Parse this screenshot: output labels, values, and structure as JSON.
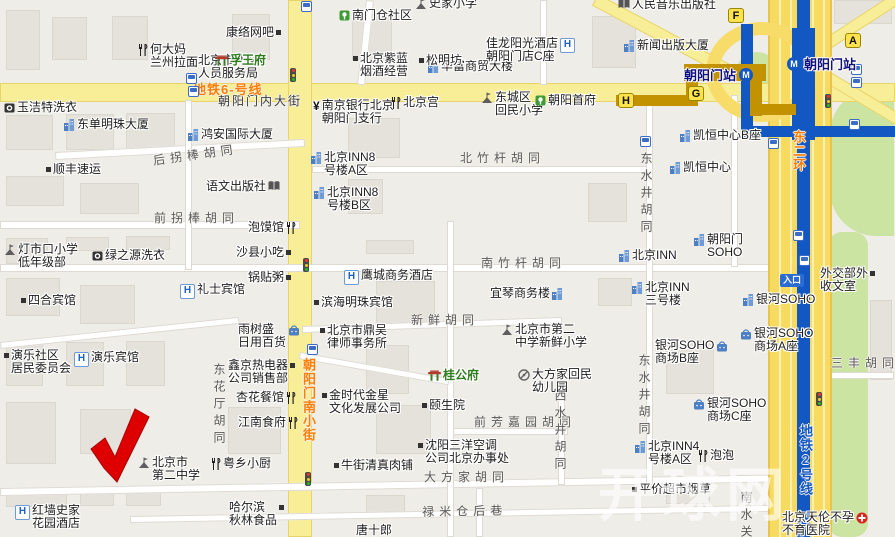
{
  "map": {
    "watermark": "开球网",
    "colors": {
      "background": "#EFEDE7",
      "road_yellow": "#F9EE98",
      "highway_yellow": "#F7DA60",
      "park_green": "#CBE4A2",
      "metro_line2_blue": "#1357C2",
      "metro_line6_gold": "#C29200",
      "station_text_navy": "#10107E",
      "road_label_orange": "#FF7E00",
      "marker_red": "#DE0000"
    },
    "subway": {
      "line6": {
        "station": "朝阳门站"
      },
      "line2": {
        "station": "朝阳门站"
      },
      "entrance_label": "入口",
      "exits": [
        {
          "label": "F",
          "x": 728,
          "y": 8
        },
        {
          "label": "A",
          "x": 845,
          "y": 33
        },
        {
          "label": "G",
          "x": 688,
          "y": 86
        },
        {
          "label": "H",
          "x": 618,
          "y": 93
        }
      ]
    },
    "road_labels": [
      {
        "text": "朝阳门内大街",
        "x": 218,
        "y": 92,
        "dir": "h",
        "cls": "streetmain"
      },
      {
        "text": "后拐棒胡同",
        "x": 152,
        "y": 152,
        "dir": "h",
        "rot": -8
      },
      {
        "text": "前拐棒胡同",
        "x": 154,
        "y": 209,
        "dir": "h"
      },
      {
        "text": "北竹杆胡同",
        "x": 460,
        "y": 149,
        "dir": "h"
      },
      {
        "text": "南竹杆胡同",
        "x": 481,
        "y": 254,
        "dir": "h"
      },
      {
        "text": "新鲜胡同",
        "x": 411,
        "y": 311,
        "dir": "h"
      },
      {
        "text": "前芳嘉园胡同",
        "x": 474,
        "y": 413,
        "dir": "h"
      },
      {
        "text": "大方家胡同",
        "x": 424,
        "y": 468,
        "dir": "h"
      },
      {
        "text": "禄米仓后巷",
        "x": 422,
        "y": 503,
        "dir": "h",
        "rot": -1
      },
      {
        "text": "东花厅胡同",
        "x": 211,
        "y": 363,
        "dir": "v"
      },
      {
        "text": "西水井胡同",
        "x": 552,
        "y": 389,
        "dir": "v"
      },
      {
        "text": "东水井胡同",
        "x": 638,
        "y": 152,
        "dir": "v"
      },
      {
        "text": "东水井胡同",
        "x": 636,
        "y": 354,
        "dir": "v"
      },
      {
        "text": "南水关",
        "x": 738,
        "y": 491,
        "dir": "v"
      },
      {
        "text": "三丰胡同",
        "x": 831,
        "y": 354,
        "dir": "h"
      },
      {
        "text": "地铁6-号线",
        "x": 193,
        "y": 79,
        "dir": "h",
        "cls": "orange"
      },
      {
        "text": "朝阳门南小街",
        "x": 299,
        "y": 358,
        "dir": "v",
        "cls": "orange"
      },
      {
        "text": "东二环",
        "x": 789,
        "y": 130,
        "dir": "v",
        "cls": "orange"
      },
      {
        "text": "地铁2号线",
        "x": 796,
        "y": 424,
        "dir": "v",
        "cls": "blue"
      }
    ],
    "pois": [
      {
        "x": 428,
        "y": 60,
        "icon": "building",
        "side": "left",
        "lines": [
          "华富商贸大楼"
        ]
      },
      {
        "x": 226,
        "y": 26,
        "icon": "dot",
        "side": "right",
        "lines": [
          "康络网吧"
        ]
      },
      {
        "x": 191,
        "y": 54,
        "icon": "dot",
        "side": "left",
        "lines": [
          "北京市外交",
          "人员服务局"
        ]
      },
      {
        "x": 138,
        "y": 43,
        "icon": "fork",
        "side": "left",
        "lines": [
          "何大妈",
          "兰州拉面"
        ]
      },
      {
        "x": 215,
        "y": 54,
        "icon": "mansion",
        "side": "left",
        "cls": "green-name",
        "lines": [
          "孚王府"
        ]
      },
      {
        "x": 4,
        "y": 101,
        "icon": "laundry",
        "side": "left",
        "lines": [
          "玉洁特洗衣"
        ]
      },
      {
        "x": 64,
        "y": 118,
        "icon": "building",
        "side": "left",
        "lines": [
          "东单明珠大厦"
        ]
      },
      {
        "x": 188,
        "y": 128,
        "icon": "building",
        "side": "left",
        "lines": [
          "鸿安国际大厦"
        ]
      },
      {
        "x": 46,
        "y": 163,
        "icon": "dot",
        "side": "left",
        "lines": [
          "顺丰速运"
        ]
      },
      {
        "x": 206,
        "y": 180,
        "icon": "book",
        "side": "right",
        "lines": [
          "语文出版社"
        ]
      },
      {
        "x": 248,
        "y": 221,
        "icon": "fork",
        "side": "right",
        "lines": [
          "泡馍馆"
        ]
      },
      {
        "x": 4,
        "y": 243,
        "icon": "school",
        "side": "left",
        "lines": [
          "灯市口小学",
          "低年级部"
        ]
      },
      {
        "x": 92,
        "y": 249,
        "icon": "laundry",
        "side": "left",
        "lines": [
          "绿之源洗衣"
        ]
      },
      {
        "x": 236,
        "y": 246,
        "icon": "dot",
        "side": "right",
        "lines": [
          "沙县小吃"
        ]
      },
      {
        "x": 248,
        "y": 271,
        "icon": "dot",
        "side": "right",
        "lines": [
          "锅贴粥"
        ]
      },
      {
        "x": 180,
        "y": 283,
        "icon": "hotel",
        "side": "left",
        "lines": [
          "礼士宾馆"
        ]
      },
      {
        "x": 21,
        "y": 294,
        "icon": "dot",
        "side": "left",
        "lines": [
          "四合宾馆"
        ]
      },
      {
        "x": 238,
        "y": 323,
        "icon": "bag",
        "side": "right",
        "lines": [
          "雨树盛",
          "日用百货"
        ]
      },
      {
        "x": 4,
        "y": 349,
        "icon": "dot",
        "side": "left",
        "lines": [
          "演乐社区",
          "居民委员会"
        ]
      },
      {
        "x": 74,
        "y": 351,
        "icon": "hotel",
        "side": "left",
        "lines": [
          "演乐宾馆"
        ]
      },
      {
        "x": 228,
        "y": 359,
        "icon": "dot",
        "side": "right",
        "lines": [
          "鑫京热电器",
          "公司销售部"
        ]
      },
      {
        "x": 236,
        "y": 391,
        "icon": "fork",
        "side": "right",
        "lines": [
          "杏花餐馆"
        ]
      },
      {
        "x": 238,
        "y": 416,
        "icon": "fork",
        "side": "right",
        "lines": [
          "江南食府"
        ]
      },
      {
        "x": 138,
        "y": 456,
        "icon": "school",
        "side": "left",
        "lines": [
          "北京市",
          "第二中学"
        ]
      },
      {
        "x": 211,
        "y": 457,
        "icon": "fork",
        "side": "left",
        "lines": [
          "粤乡小厨"
        ]
      },
      {
        "x": 15,
        "y": 504,
        "icon": "hotel",
        "side": "left",
        "lines": [
          "红墙史家",
          "花园酒店"
        ]
      },
      {
        "x": 229,
        "y": 501,
        "icon": "dot",
        "side": "right",
        "lines": [
          "哈尔滨",
          "秋林食品"
        ]
      },
      {
        "x": 415,
        "y": -3,
        "icon": "school",
        "side": "left",
        "lines": [
          "史家小学"
        ]
      },
      {
        "x": 339,
        "y": 9,
        "icon": "community",
        "side": "left",
        "lines": [
          "南门仓社区"
        ]
      },
      {
        "x": 353,
        "y": 52,
        "icon": "dot",
        "side": "left",
        "lines": [
          "北京紫蓝",
          "烟酒经营"
        ]
      },
      {
        "x": 419,
        "y": 54,
        "icon": "dot",
        "side": "left",
        "lines": [
          "松明坊"
        ]
      },
      {
        "x": 486,
        "y": 37,
        "icon": "hotel",
        "side": "right",
        "lines": [
          "佳龙阳光酒店",
          "朝阳门店C座"
        ]
      },
      {
        "x": 481,
        "y": 91,
        "icon": "school",
        "side": "left",
        "lines": [
          "东城区",
          "回民小学"
        ]
      },
      {
        "x": 535,
        "y": 94,
        "icon": "community",
        "side": "left",
        "lines": [
          "朝阳首府"
        ]
      },
      {
        "x": 313,
        "y": 99,
        "icon": "bank",
        "side": "left",
        "lines": [
          "南京银行北京",
          "朝阳门支行"
        ]
      },
      {
        "x": 391,
        "y": 96,
        "icon": "fork",
        "side": "left",
        "lines": [
          "北京宫"
        ]
      },
      {
        "x": 311,
        "y": 151,
        "icon": "building",
        "side": "left",
        "lines": [
          "北京INN8",
          "号楼A区"
        ]
      },
      {
        "x": 314,
        "y": 186,
        "icon": "building",
        "side": "left",
        "lines": [
          "北京INN8",
          "号楼B区"
        ]
      },
      {
        "x": 680,
        "y": 129,
        "icon": "building",
        "side": "left",
        "lines": [
          "凯恒中心B座"
        ]
      },
      {
        "x": 670,
        "y": 161,
        "icon": "building",
        "side": "left",
        "lines": [
          "凯恒中心"
        ]
      },
      {
        "x": 344,
        "y": 269,
        "icon": "hotel",
        "side": "left",
        "lines": [
          "鹰城商务酒店"
        ]
      },
      {
        "x": 314,
        "y": 296,
        "icon": "dot",
        "side": "left",
        "lines": [
          "滨海明珠宾馆"
        ]
      },
      {
        "x": 490,
        "y": 287,
        "icon": "building",
        "side": "right",
        "lines": [
          "宜琴商务楼"
        ]
      },
      {
        "x": 501,
        "y": 323,
        "icon": "school",
        "side": "left",
        "lines": [
          "北京市第二",
          "中学新鲜小学"
        ]
      },
      {
        "x": 320,
        "y": 324,
        "icon": "dot",
        "side": "left",
        "lines": [
          "北京市鼎吴",
          "律师事务所"
        ]
      },
      {
        "x": 428,
        "y": 369,
        "icon": "mansion",
        "side": "left",
        "cls": "green-name",
        "lines": [
          "桂公府"
        ]
      },
      {
        "x": 518,
        "y": 368,
        "icon": "kindergarten",
        "side": "left",
        "lines": [
          "大方家回民",
          "幼儿园"
        ]
      },
      {
        "x": 322,
        "y": 389,
        "icon": "dot",
        "side": "left",
        "lines": [
          "金时代金星",
          "文化发展公司"
        ]
      },
      {
        "x": 422,
        "y": 399,
        "icon": "dot",
        "side": "left",
        "lines": [
          "颐生院"
        ]
      },
      {
        "x": 418,
        "y": 439,
        "icon": "dot",
        "side": "left",
        "lines": [
          "沈阳三洋空调",
          "公司北京办事处"
        ]
      },
      {
        "x": 334,
        "y": 459,
        "icon": "dot",
        "side": "left",
        "lines": [
          "牛街清真肉铺"
        ]
      },
      {
        "x": 618,
        "y": -2,
        "icon": "book",
        "side": "left",
        "lines": [
          "人民音乐出版社"
        ]
      },
      {
        "x": 624,
        "y": 39,
        "icon": "building",
        "side": "left",
        "lines": [
          "新闻出版大厦"
        ]
      },
      {
        "x": 694,
        "y": 233,
        "icon": "building",
        "side": "left",
        "lines": [
          "朝阳门",
          "SOHO"
        ]
      },
      {
        "x": 619,
        "y": 249,
        "icon": "building",
        "side": "left",
        "lines": [
          "北京INN"
        ]
      },
      {
        "x": 632,
        "y": 281,
        "icon": "building",
        "side": "left",
        "lines": [
          "北京INN",
          "三号楼"
        ]
      },
      {
        "x": 743,
        "y": 293,
        "icon": "building",
        "side": "left",
        "lines": [
          "银河SOHO"
        ]
      },
      {
        "x": 820,
        "y": 267,
        "icon": "dot",
        "side": "right",
        "lines": [
          "外交部外",
          "收文室"
        ]
      },
      {
        "x": 655,
        "y": 339,
        "icon": "bag",
        "side": "right",
        "lines": [
          "银河SOHO",
          "商场B座"
        ]
      },
      {
        "x": 740,
        "y": 327,
        "icon": "bag",
        "side": "left",
        "lines": [
          "银河SOHO",
          "商场A座"
        ]
      },
      {
        "x": 693,
        "y": 397,
        "icon": "bag",
        "side": "left",
        "lines": [
          "银河SOHO",
          "商场C座"
        ]
      },
      {
        "x": 635,
        "y": 440,
        "icon": "building",
        "side": "left",
        "lines": [
          "北京INN4",
          "号楼A区"
        ]
      },
      {
        "x": 698,
        "y": 449,
        "icon": "fork",
        "side": "left",
        "lines": [
          "泡泡"
        ]
      },
      {
        "x": 632,
        "y": 483,
        "icon": "dot",
        "side": "left",
        "lines": [
          "平价超市烟草"
        ]
      },
      {
        "x": 782,
        "y": 511,
        "icon": "hospital",
        "side": "right",
        "lines": [
          "北京天伦不孕",
          "不育医院"
        ]
      },
      {
        "x": 356,
        "y": 524,
        "icon": "none",
        "side": "left",
        "lines": [
          "唐十郎"
        ]
      }
    ]
  }
}
